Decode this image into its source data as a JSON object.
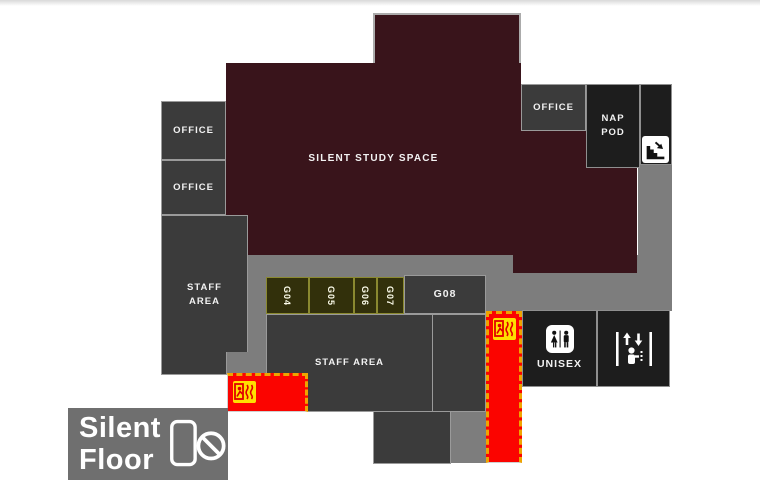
{
  "legend": {
    "line1": "Silent",
    "line2": "Floor"
  },
  "rooms": {
    "office1": "OFFICE",
    "office2": "OFFICE",
    "staff_left": "STAFF AREA",
    "silent_study": "SILENT STUDY SPACE",
    "office_top": "OFFICE",
    "nap_pod": "NAP POD",
    "g04": "G04",
    "g05": "G05",
    "g06": "G06",
    "g07": "G07",
    "g08": "G08",
    "staff_mid": "STAFF AREA",
    "unisex": "UNISEX"
  },
  "colors": {
    "silent_study_maroon": "#39141b",
    "room_dark_gray": "#3b3b3b",
    "room_black": "#1d1d1d",
    "corridor_gray": "#7d7d7d",
    "study_room_olive": "#32300b",
    "emergency_red": "#fb0400",
    "hazard_dash_orange": "#efa400",
    "exit_icon_yellow": "#ffdf00",
    "legend_gray": "#6f6f6f"
  },
  "icons": {
    "stairs": "stairs-down-with-arrow",
    "emergency_exit": "running-man-fire-exit",
    "unisex_toilet": "female-male-figures",
    "elevator": "lift-person-up-down-arrows",
    "no_phone": "phone-prohibited"
  }
}
